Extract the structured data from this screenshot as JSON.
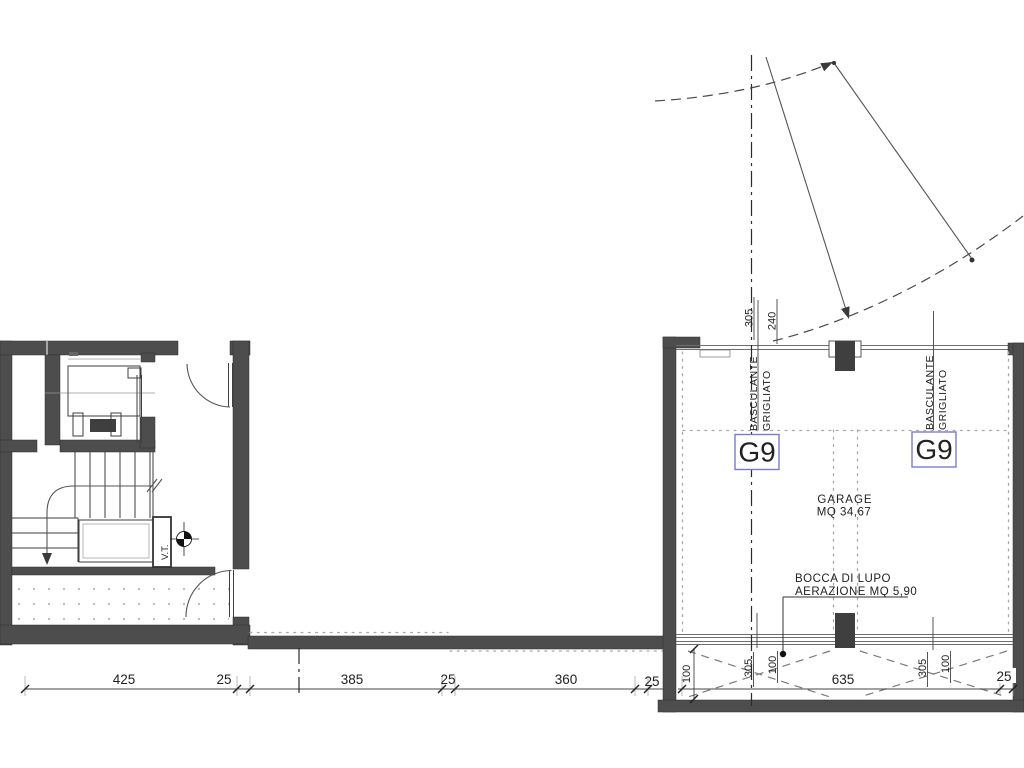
{
  "labels": {
    "garage_name": "GARAGE",
    "garage_area": "MQ 34,67",
    "unit_code": "G9",
    "door_type_line1": "BASCULANTE",
    "door_type_line2": "GRIGLIATO",
    "vent_line1": "BOCCA DI LUPO",
    "vent_line2": "AERAZIONE MQ 5,90",
    "tech_shaft": "V.T."
  },
  "dimensions": {
    "bottom_chain": [
      "425",
      "25",
      "385",
      "25",
      "360",
      "25"
    ],
    "garage_chain": [
      "635",
      "25"
    ],
    "lightwell_height": "100",
    "top_axis": [
      "305",
      "240"
    ],
    "lightwell_left": [
      "305",
      "100"
    ],
    "lightwell_right": [
      "305",
      "100"
    ]
  },
  "colors": {
    "wall_gray": "#4d4d4d",
    "line_dark": "#444444",
    "unit_blue": "#1f1fcc",
    "unit_box_blue": "#7a7ad0",
    "dotted_gray": "#a8a8a8",
    "background": "#ffffff"
  }
}
